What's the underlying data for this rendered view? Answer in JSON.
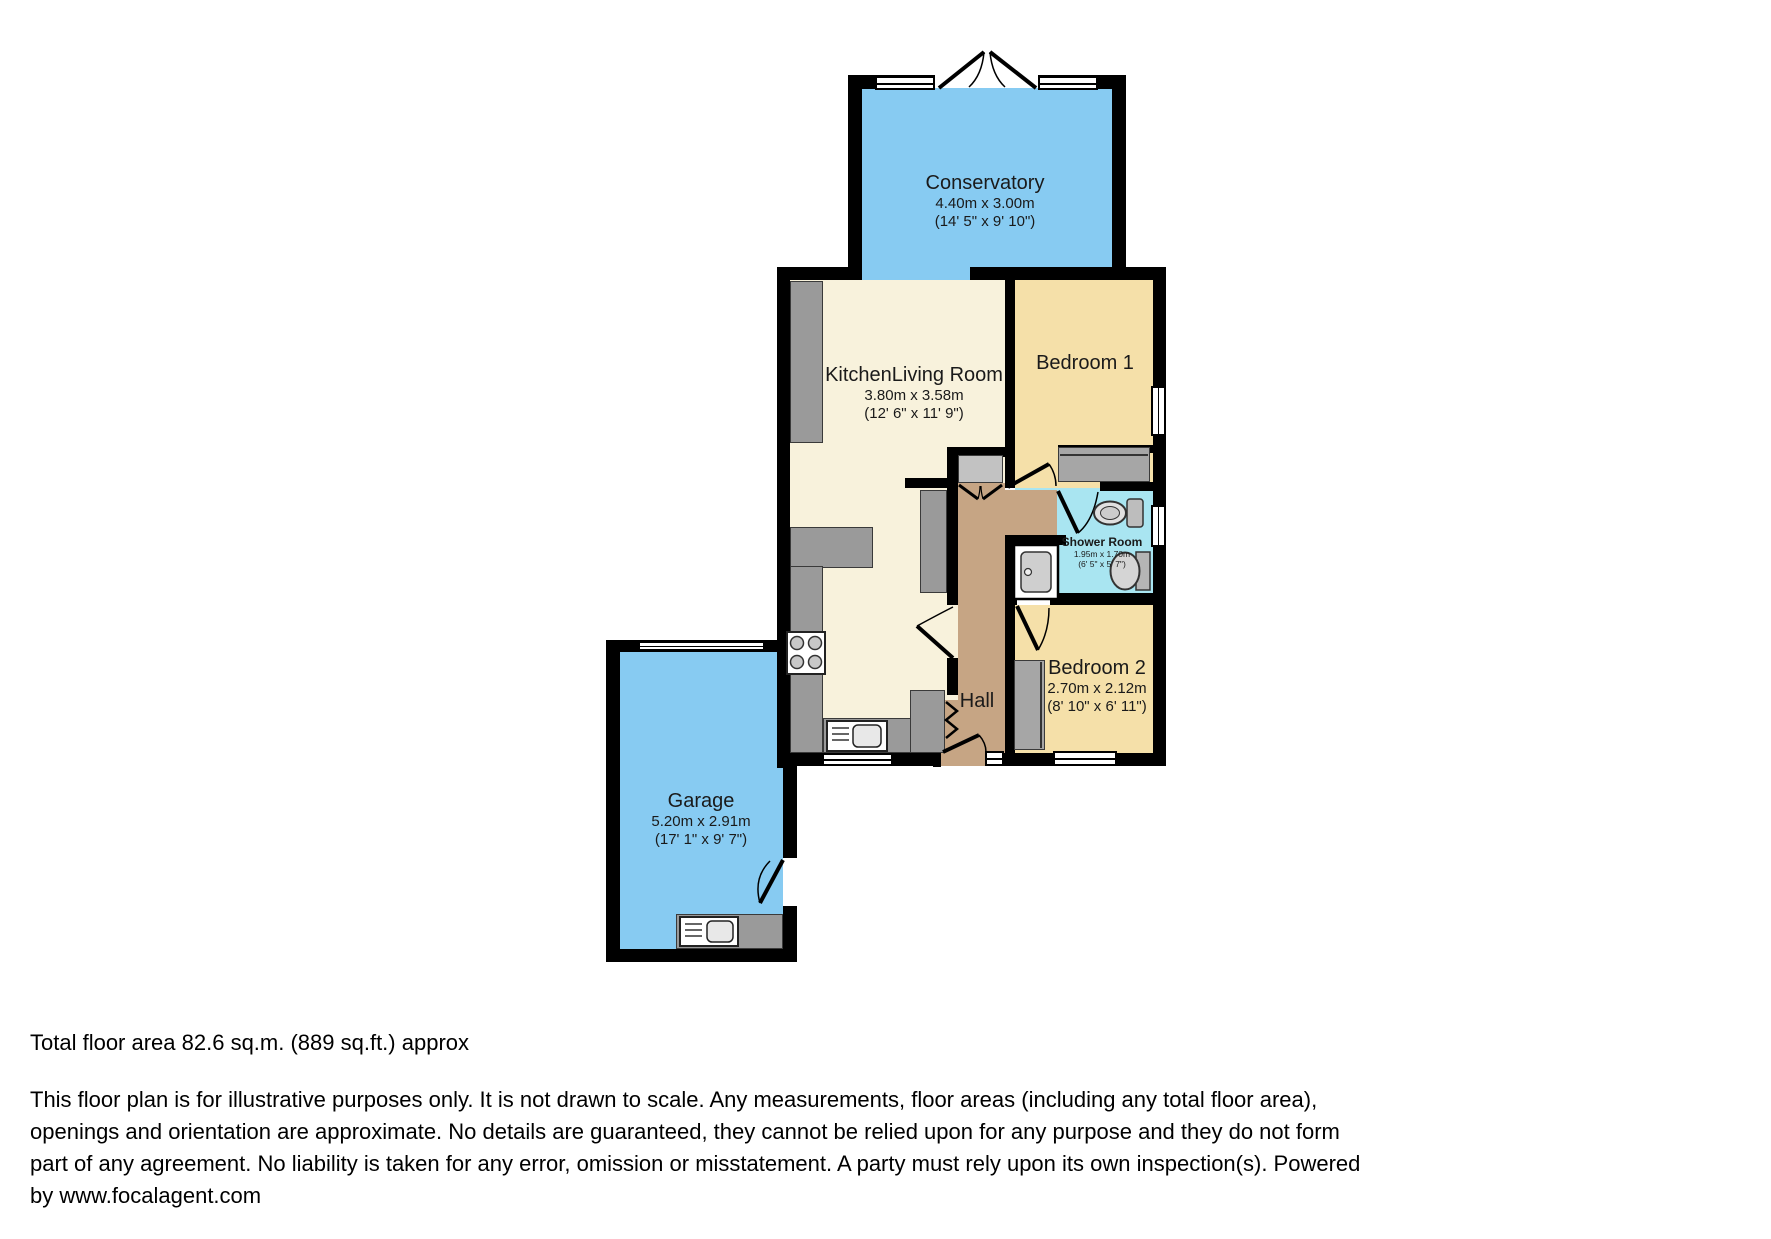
{
  "colors": {
    "blue": "#87CBF2",
    "cream": "#F8F2DC",
    "tan": "#F5E0A9",
    "cyan": "#A9E5F1",
    "brown": "#C6A584",
    "counter": "#9A9A9A",
    "closet": "#C2C2C2",
    "wardrobe": "#A6A6A6",
    "wall": "#000000"
  },
  "rooms": {
    "conservatory": {
      "name": "Conservatory",
      "metric": "4.40m x 3.00m",
      "imperial": "(14' 5\" x 9' 10\")"
    },
    "kitchen_living": {
      "name": "KitchenLiving Room",
      "metric": "3.80m x 3.58m",
      "imperial": "(12' 6\" x 11' 9\")"
    },
    "bedroom1": {
      "name": "Bedroom 1"
    },
    "shower": {
      "name": "Shower Room",
      "metric": "1.95m x 1.70m",
      "imperial": "(6' 5\" x 5' 7\")"
    },
    "bedroom2": {
      "name": "Bedroom 2",
      "metric": "2.70m x 2.12m",
      "imperial": "(8' 10\" x 6' 11\")"
    },
    "hall": {
      "name": "Hall"
    },
    "garage": {
      "name": "Garage",
      "metric": "5.20m x 2.91m",
      "imperial": "(17' 1\" x 9' 7\")"
    }
  },
  "footer": {
    "total_area": "Total floor area 82.6 sq.m. (889 sq.ft.) approx",
    "disclaimer_lines": [
      "This floor plan is for illustrative purposes only. It is not drawn to scale. Any measurements, floor areas (including any total floor area),",
      "openings and orientation are approximate. No details are guaranteed, they cannot be relied upon for any purpose and they do not form",
      "part of any agreement. No liability is taken for any error, omission or misstatement. A party must rely upon its own inspection(s). Powered",
      "by www.focalagent.com"
    ]
  }
}
